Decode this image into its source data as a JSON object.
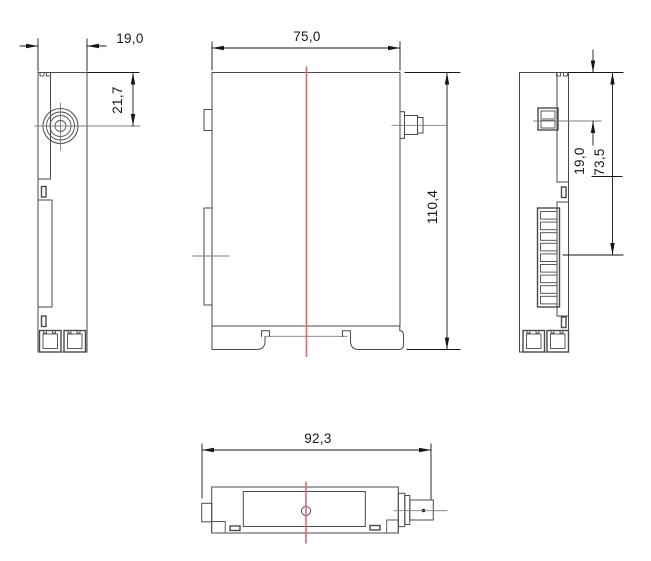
{
  "page": {
    "background": "#ffffff"
  },
  "drawing": {
    "colors": {
      "line_color": "#4a4a4a",
      "dimension_color": "#161616",
      "centerline_color": "#7d7d7d",
      "red_centerline_color": "#d96b6e"
    },
    "views": {
      "left_side": {
        "dim_width": {
          "label": "19,0"
        },
        "dim_connector_offset": {
          "label": "21,7"
        }
      },
      "front": {
        "dim_width": {
          "label": "75,0"
        },
        "dim_height": {
          "label": "110,4"
        }
      },
      "right_side": {
        "dim_connector_offset": {
          "label": "19,0"
        },
        "dim_terminal_offset": {
          "label": "73,5"
        }
      },
      "bottom": {
        "dim_depth": {
          "label": "92,3"
        }
      }
    }
  }
}
